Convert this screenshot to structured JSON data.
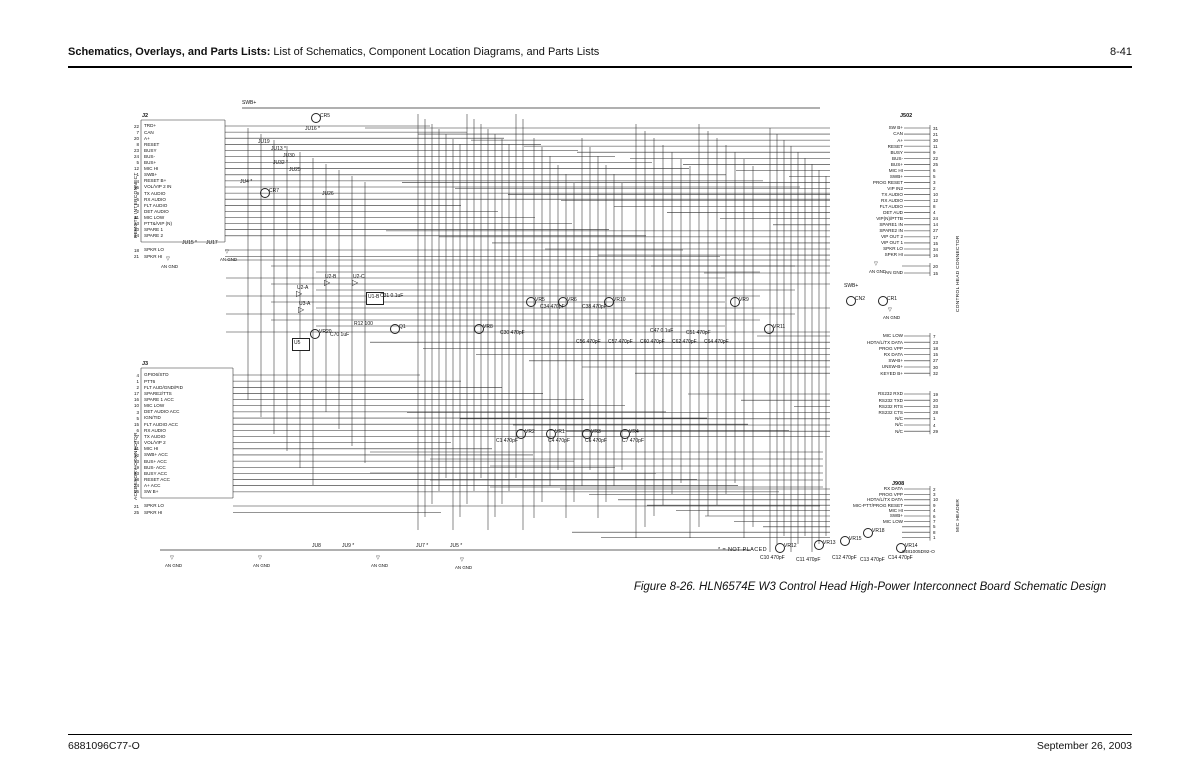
{
  "page": {
    "header": {
      "title_bold": "Schematics, Overlays, and Parts Lists:",
      "title_rest": " List of Schematics, Component Location Diagrams, and Parts Lists",
      "page_number": "8-41"
    },
    "footer": {
      "doc_number": "6881096C77-O",
      "date": "September 26, 2003"
    },
    "caption": "Figure 8-26. HLN6574E W3 Control Head High-Power Interconnect Board Schematic Design"
  },
  "schematic": {
    "note": "* = NOT PLACED",
    "board_number": "6481005D92-O",
    "connectors": {
      "remote": {
        "id": "J2",
        "side_label": "REMOTE INTERCONNECT",
        "pins": [
          {
            "n": "22",
            "l": "TRD+"
          },
          {
            "n": "7",
            "l": "CAN"
          },
          {
            "n": "20",
            "l": "A+"
          },
          {
            "n": "8",
            "l": "RESET"
          },
          {
            "n": "23",
            "l": "BUSY"
          },
          {
            "n": "24",
            "l": "BUS-"
          },
          {
            "n": "5",
            "l": "BUS+"
          },
          {
            "n": "12",
            "l": "MIC HI"
          },
          {
            "n": "1",
            "l": "SWB+"
          },
          {
            "n": "4",
            "l": "RESET B+"
          },
          {
            "n": "15",
            "l": "VOL/VIP 2 IN"
          },
          {
            "n": "9",
            "l": "TX AUDIO"
          },
          {
            "n": "6",
            "l": "RX AUDIO"
          },
          {
            "n": "3",
            "l": "FLT AUDIO"
          },
          {
            "n": "2",
            "l": "DET AUDIO"
          },
          {
            "n": "11",
            "l": "MIC LOW"
          },
          {
            "n": "13",
            "l": "PTT&/VIP (N)"
          },
          {
            "n": "10",
            "l": "SPARE 1"
          },
          {
            "n": "14",
            "l": "SPARE 2"
          }
        ],
        "pins2": [
          {
            "n": "18",
            "l": "SPKR LO"
          },
          {
            "n": "21",
            "l": "SPKR HI"
          }
        ]
      },
      "accessory": {
        "id": "J3",
        "side_label": "ACCESSORY CONNECTOR",
        "pins": [
          {
            "n": "4",
            "l": "GPIO6/STD"
          },
          {
            "n": "1",
            "l": "PTT6"
          },
          {
            "n": "2",
            "l": "FLT AUD/GND/PID"
          },
          {
            "n": "17",
            "l": "SPARE2/TTS"
          },
          {
            "n": "16",
            "l": "SPARE 1 ACC"
          },
          {
            "n": "10",
            "l": "MIC LOW"
          },
          {
            "n": "3",
            "l": "DET AUDIO ACC"
          },
          {
            "n": "5",
            "l": "IGN/TID"
          },
          {
            "n": "15",
            "l": "FLT AUDIO ACC"
          },
          {
            "n": "6",
            "l": "RX AUDIO"
          },
          {
            "n": "7",
            "l": "TX AUDIO"
          },
          {
            "n": "14",
            "l": "VOL/VIP 2"
          },
          {
            "n": "11",
            "l": "MIC HI"
          },
          {
            "n": "12",
            "l": "SWB+ ACC"
          },
          {
            "n": "13",
            "l": "BUS+ ACC"
          },
          {
            "n": "19",
            "l": "BUS- ACC"
          },
          {
            "n": "23",
            "l": "BUSY ACC"
          },
          {
            "n": "18",
            "l": "RESET ACC"
          },
          {
            "n": "24",
            "l": "A+ ACC"
          },
          {
            "n": "26",
            "l": "SW B+"
          }
        ],
        "pins2": [
          {
            "n": "21",
            "l": "SPKR LO"
          },
          {
            "n": "25",
            "l": "SPKR HI"
          }
        ]
      },
      "control_head": {
        "id": "J502",
        "side_label": "CONTROL HEAD CONNECTOR",
        "pins": [
          {
            "n": "31",
            "l": "SW B+"
          },
          {
            "n": "21",
            "l": "CAN"
          },
          {
            "n": "30",
            "l": "A+"
          },
          {
            "n": "11",
            "l": "RESET"
          },
          {
            "n": "9",
            "l": "BUSY"
          },
          {
            "n": "22",
            "l": "BUS-"
          },
          {
            "n": "25",
            "l": "BUS+"
          },
          {
            "n": "6",
            "l": "MIC HI"
          },
          {
            "n": "5",
            "l": "SWB+"
          },
          {
            "n": "3",
            "l": "PROG RESET"
          },
          {
            "n": "2",
            "l": "VIP IN2"
          },
          {
            "n": "10",
            "l": "TX AUDIO"
          },
          {
            "n": "12",
            "l": "RX AUDIO"
          },
          {
            "n": "8",
            "l": "FLT AUDIO"
          },
          {
            "n": "4",
            "l": "DET AUD"
          },
          {
            "n": "24",
            "l": "VIP(N)/PTTB"
          },
          {
            "n": "14",
            "l": "SPARE1 IN"
          },
          {
            "n": "27",
            "l": "SPARE2 IN"
          },
          {
            "n": "17",
            "l": "VIP OUT 2"
          },
          {
            "n": "15",
            "l": "VIP OUT 1"
          },
          {
            "n": "34",
            "l": "SPKR LO"
          },
          {
            "n": "16",
            "l": "SPKR HI"
          }
        ],
        "pins_gnd": [
          {
            "n": "20",
            "l": ""
          },
          {
            "n": "15",
            "l": "AN GND"
          }
        ],
        "pins_mid": [
          {
            "n": "7",
            "l": "MIC LOW"
          },
          {
            "n": "23",
            "l": "HDTA/L/TX DATA"
          },
          {
            "n": "18",
            "l": "PROG VPP"
          },
          {
            "n": "15",
            "l": "RX DATA"
          },
          {
            "n": "27",
            "l": "SW-B+"
          },
          {
            "n": "30",
            "l": "UNSW-B+"
          },
          {
            "n": "32",
            "l": "KEYED B+"
          }
        ],
        "pins_rs232": [
          {
            "n": "19",
            "l": "RS232 RXD"
          },
          {
            "n": "20",
            "l": "RS232 TXD"
          },
          {
            "n": "33",
            "l": "RS232 RTS"
          },
          {
            "n": "28",
            "l": "RS232 CTS"
          },
          {
            "n": "1",
            "l": "N/C"
          },
          {
            "n": "4",
            "l": "N/C"
          },
          {
            "n": "29",
            "l": "N/C"
          }
        ]
      },
      "mic_header": {
        "id": "J908",
        "side_label": "MIC HEADER",
        "pins": [
          {
            "n": "2",
            "l": "RX DATA"
          },
          {
            "n": "3",
            "l": "PROG VPP"
          },
          {
            "n": "10",
            "l": "HDTA/L/TX DATA"
          },
          {
            "n": "9",
            "l": "MIC-PTT/PROG RESET"
          },
          {
            "n": "4",
            "l": "MIC HI"
          },
          {
            "n": "6",
            "l": "SWB+"
          },
          {
            "n": "7",
            "l": "MIC LOW"
          },
          {
            "n": "5",
            "l": ""
          },
          {
            "n": "8",
            "l": ""
          },
          {
            "n": "1",
            "l": ""
          }
        ]
      }
    },
    "components": [
      "SWB+",
      "CR5",
      "JU16 *",
      "JU19",
      "JU13 *",
      "JU30",
      "JU32 *",
      "JU25",
      "JU4 *",
      "CR7",
      "JU26",
      "JU15 *",
      "JU17",
      "AN GND",
      "AN GND",
      "U2-A",
      "U2-B",
      "U2-C",
      "U1-B",
      "U3-A",
      "R12 100",
      "C31 0.1uF",
      "VR20",
      "C70 1uF",
      "Q1",
      "U5",
      "VR5",
      "C34 470pF",
      "VR6",
      "VR10",
      "C38 470pF",
      "VR8",
      "C30 470pF",
      "C47 0.1uF",
      "C51 470pF",
      "C56 470pF",
      "C57 470pF",
      "C60 470pF",
      "C62 470pF",
      "VR9",
      "VR11",
      "C64 470pF",
      "SWB+",
      "CN2",
      "CR1",
      "AN GND",
      "AN GND",
      "VR2",
      "C1 470pF",
      "VR1",
      "C4 470pF",
      "VR3",
      "C6 470pF",
      "VR4",
      "C7 470pF",
      "JU8",
      "JU9 *",
      "JU7 *",
      "JU5 *",
      "AN GND",
      "AN GND",
      "AN GND",
      "AN GND",
      "VR12",
      "VR13",
      "VR15",
      "VR18",
      "VR14",
      "C10 470pF",
      "C11 470pF",
      "C12 470pF",
      "C13 470pF",
      "C14 470pF"
    ]
  }
}
